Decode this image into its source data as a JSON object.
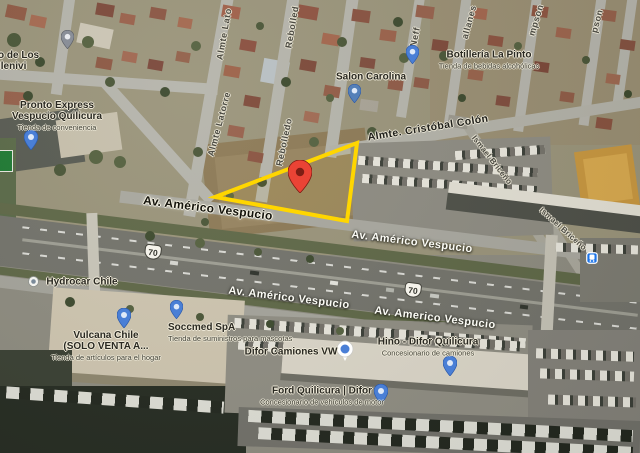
{
  "map_overlay": {
    "triangle_color": "#FFD600",
    "marker_color": "#EA4335",
    "pin_color": "#4a7fd6"
  },
  "streets": {
    "almte_latorre_top": "Almte Lato",
    "almte_latorre": "Almte Latorre",
    "rebolledo_top": "Rebolled",
    "rebolledo": "Rebolledo",
    "neff": "Neff",
    "magallanes_partial": "allanes",
    "thompson_partial_a": "mpson",
    "thompson_partial_b": "pson",
    "ismael_briceno_a": "Ismael Briceño",
    "ismael_briceno_b": "Ismael Briceño",
    "cristobal_colon": "Almte. Cristóbal Colón"
  },
  "avenues": {
    "vespucio_1": "Av. Américo Vespucio",
    "vespucio_2": "Av. Américo Vespucio",
    "vespucio_3": "Av. Américo Vespucio",
    "vespucio_4": "Av. Americo Vespucio"
  },
  "route_shields": {
    "shield_a": "70",
    "shield_b": "70"
  },
  "places": {
    "cut_poi": {
      "line1": "o de Los",
      "line2": "llenivi"
    },
    "pronto_express": {
      "line1": "Pronto Express",
      "line2": "Vespucio Quilicura",
      "subtitle": "Tienda de conveniencia"
    },
    "salon_carolina": {
      "title": "Salon Carolina"
    },
    "botilleria_la_pinto": {
      "title": "Botillería La Pinto",
      "subtitle": "Tienda de bebidas alcohólicas"
    },
    "hydrocar_chile": {
      "title": "Hydrocar Chile"
    },
    "vulcana_chile": {
      "line1": "Vulcana Chile",
      "line2": "(SOLO VENTA A...",
      "subtitle": "Tienda de artículos para el hogar"
    },
    "soccmed_spa": {
      "title": "Soccmed SpA",
      "subtitle": "Tienda de suministros para mascotas"
    },
    "difor_camiones": {
      "title": "Difor Camiones VW"
    },
    "hino_difor": {
      "title": "Hino - Difor Quilicura",
      "subtitle": "Concesionario de camiones"
    },
    "ford_quilicura": {
      "title": "Ford Quilicura | Difor",
      "subtitle": "Concesionario de vehículos de motor"
    }
  }
}
